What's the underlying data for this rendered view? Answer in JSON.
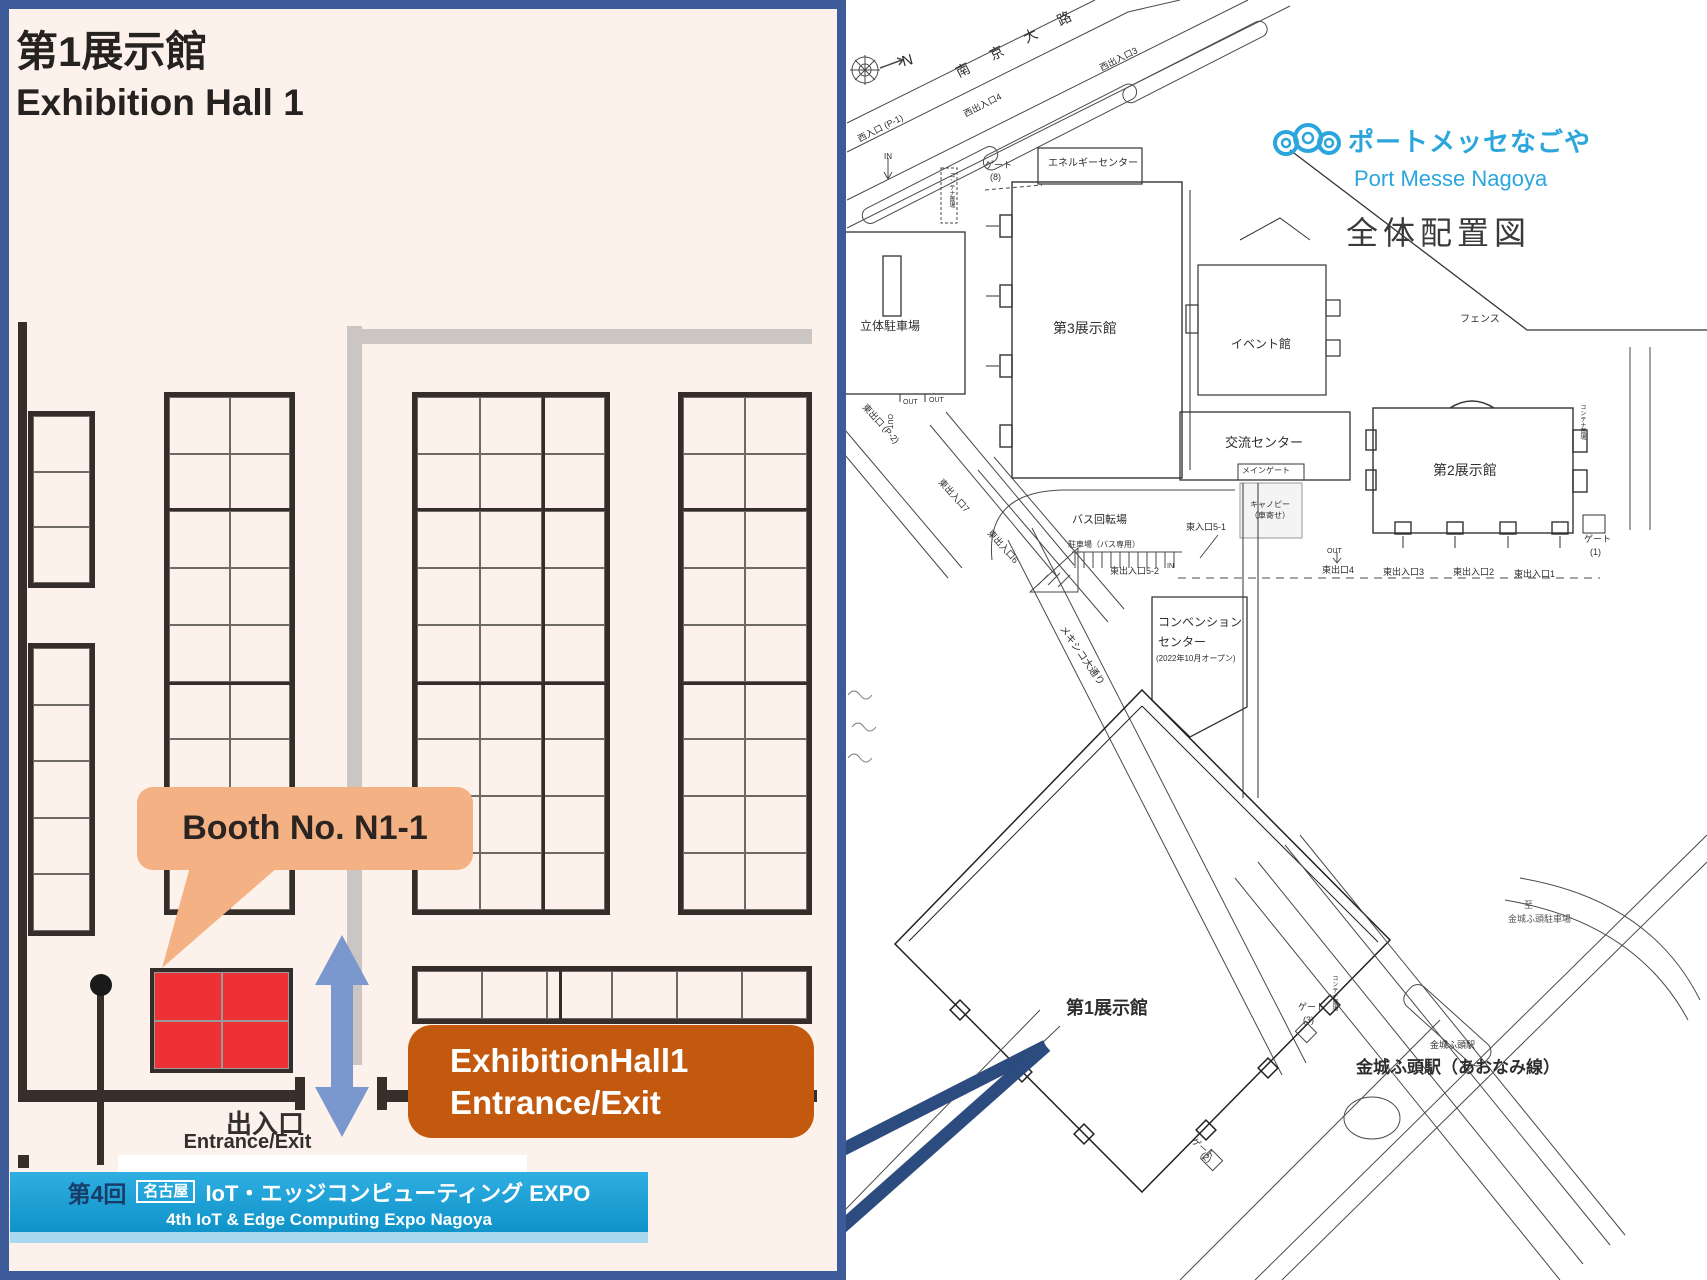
{
  "left_panel": {
    "title_jp": "第1展示館",
    "title_en": "Exhibition Hall 1",
    "booth_callout": "Booth No. N1-1",
    "exit_label_jp": "出入口",
    "exit_label_en": "Entrance/Exit",
    "entrance_box_line1": "ExhibitionHall1",
    "entrance_box_line2": "Entrance/Exit",
    "banner": {
      "edition": "第4回",
      "city_badge": "名古屋",
      "title_jp": "IoT・エッジコンピューティング EXPO",
      "title_en": "4th IoT & Edge Computing Expo Nagoya"
    },
    "colors": {
      "panel_bg": "#FCF2EB",
      "panel_border": "#3D5B99",
      "booth_highlight": "#EE3134",
      "callout_bg": "#F4B183",
      "entrance_box_bg": "#C2590F",
      "arrow_blue": "#7B98CE",
      "banner_bg": "#1CA5DC"
    }
  },
  "map": {
    "logo_jp": "ポートメッセなごや",
    "logo_en": "Port Messe Nagoya",
    "map_title": "全体配置図",
    "logo_color": "#2BA6DC",
    "pointer_color": "#2C4B7E",
    "labels": [
      {
        "text": "N",
        "x": 900,
        "y": 54,
        "fs": 15,
        "rot": -15
      },
      {
        "text": "南 京 大 路",
        "x": 953,
        "y": 66,
        "fs": 14,
        "rot": -27,
        "ls": 10
      },
      {
        "text": "西出入口3",
        "x": 1098,
        "y": 64,
        "fs": 9,
        "rot": -27
      },
      {
        "text": "西出入口4",
        "x": 962,
        "y": 110,
        "fs": 9,
        "rot": -27
      },
      {
        "text": "西入口 (P-1)",
        "x": 856,
        "y": 135,
        "fs": 9,
        "rot": -27
      },
      {
        "text": "IN",
        "x": 884,
        "y": 152,
        "fs": 8
      },
      {
        "text": "ゲート",
        "x": 985,
        "y": 160,
        "fs": 9
      },
      {
        "text": "(8)",
        "x": 990,
        "y": 172,
        "fs": 9
      },
      {
        "text": "エネルギーセンター",
        "x": 1048,
        "y": 158,
        "fs": 10
      },
      {
        "text": "コンテナ置場",
        "x": 947,
        "y": 172,
        "fs": 6,
        "vert": true
      },
      {
        "text": "立体駐車場",
        "x": 860,
        "y": 320,
        "fs": 12
      },
      {
        "text": "第3展示館",
        "x": 1053,
        "y": 320,
        "fs": 14
      },
      {
        "text": "イベント館",
        "x": 1231,
        "y": 338,
        "fs": 12
      },
      {
        "text": "フェンス",
        "x": 1460,
        "y": 314,
        "fs": 10
      },
      {
        "text": "交流センター",
        "x": 1225,
        "y": 436,
        "fs": 13
      },
      {
        "text": "メインゲート",
        "x": 1242,
        "y": 466,
        "fs": 8
      },
      {
        "text": "キャノピー",
        "x": 1250,
        "y": 500,
        "fs": 8
      },
      {
        "text": "（車寄せ）",
        "x": 1250,
        "y": 511,
        "fs": 8
      },
      {
        "text": "第2展示館",
        "x": 1433,
        "y": 462,
        "fs": 14
      },
      {
        "text": "コンテナ置場",
        "x": 1578,
        "y": 404,
        "fs": 6,
        "vert": true
      },
      {
        "text": "ゲート",
        "x": 1584,
        "y": 534,
        "fs": 9
      },
      {
        "text": "(1)",
        "x": 1590,
        "y": 547,
        "fs": 9
      },
      {
        "text": "バス回転場",
        "x": 1072,
        "y": 514,
        "fs": 11
      },
      {
        "text": "駐車場（バス専用）",
        "x": 1068,
        "y": 540,
        "fs": 8
      },
      {
        "text": "東入口5-1",
        "x": 1186,
        "y": 522,
        "fs": 9
      },
      {
        "text": "東出入口7",
        "x": 944,
        "y": 477,
        "fs": 9,
        "rot": 48
      },
      {
        "text": "東出入口6",
        "x": 993,
        "y": 528,
        "fs": 9,
        "rot": 48
      },
      {
        "text": "東出口 (P-2)",
        "x": 868,
        "y": 402,
        "fs": 9,
        "rot": 48
      },
      {
        "text": "OUT",
        "x": 903,
        "y": 399,
        "fs": 7
      },
      {
        "text": "OUT",
        "x": 929,
        "y": 397,
        "fs": 7
      },
      {
        "text": "OUT",
        "x": 893,
        "y": 414,
        "fs": 7,
        "rot": 90
      },
      {
        "text": "東出入口5-2",
        "x": 1110,
        "y": 566,
        "fs": 9
      },
      {
        "text": "IN",
        "x": 1167,
        "y": 563,
        "fs": 7
      },
      {
        "text": "OUT",
        "x": 1327,
        "y": 548,
        "fs": 7
      },
      {
        "text": "東出口4",
        "x": 1322,
        "y": 565,
        "fs": 9
      },
      {
        "text": "東出入口3",
        "x": 1383,
        "y": 567,
        "fs": 9
      },
      {
        "text": "東出入口2",
        "x": 1453,
        "y": 567,
        "fs": 9
      },
      {
        "text": "東出入口1",
        "x": 1514,
        "y": 569,
        "fs": 9
      },
      {
        "text": "コンベンション",
        "x": 1158,
        "y": 616,
        "fs": 12
      },
      {
        "text": "センター",
        "x": 1158,
        "y": 636,
        "fs": 12
      },
      {
        "text": "(2022年10月オープン)",
        "x": 1156,
        "y": 654,
        "fs": 8
      },
      {
        "text": "メキシコ大通り",
        "x": 1066,
        "y": 624,
        "fs": 10,
        "rot": 55
      },
      {
        "text": "第1展示館",
        "x": 1066,
        "y": 998,
        "fs": 18,
        "bold": true
      },
      {
        "text": "ゲート",
        "x": 1298,
        "y": 1002,
        "fs": 9
      },
      {
        "text": "(3)",
        "x": 1303,
        "y": 1015,
        "fs": 9
      },
      {
        "text": "コンテナ置場",
        "x": 1330,
        "y": 975,
        "fs": 6,
        "vert": true
      },
      {
        "text": "ゲート",
        "x": 1196,
        "y": 1136,
        "fs": 9,
        "rot": 40
      },
      {
        "text": "(2)",
        "x": 1205,
        "y": 1150,
        "fs": 9,
        "rot": 40
      },
      {
        "text": "至",
        "x": 1524,
        "y": 900,
        "fs": 9,
        "color": "#555555"
      },
      {
        "text": "金城ふ頭駐車場",
        "x": 1508,
        "y": 914,
        "fs": 9,
        "color": "#555555"
      },
      {
        "text": "金城ふ頭駅",
        "x": 1430,
        "y": 1040,
        "fs": 9
      },
      {
        "text": "金城ふ頭駅（あおなみ線）",
        "x": 1356,
        "y": 1058,
        "fs": 17,
        "bold": true
      }
    ]
  }
}
